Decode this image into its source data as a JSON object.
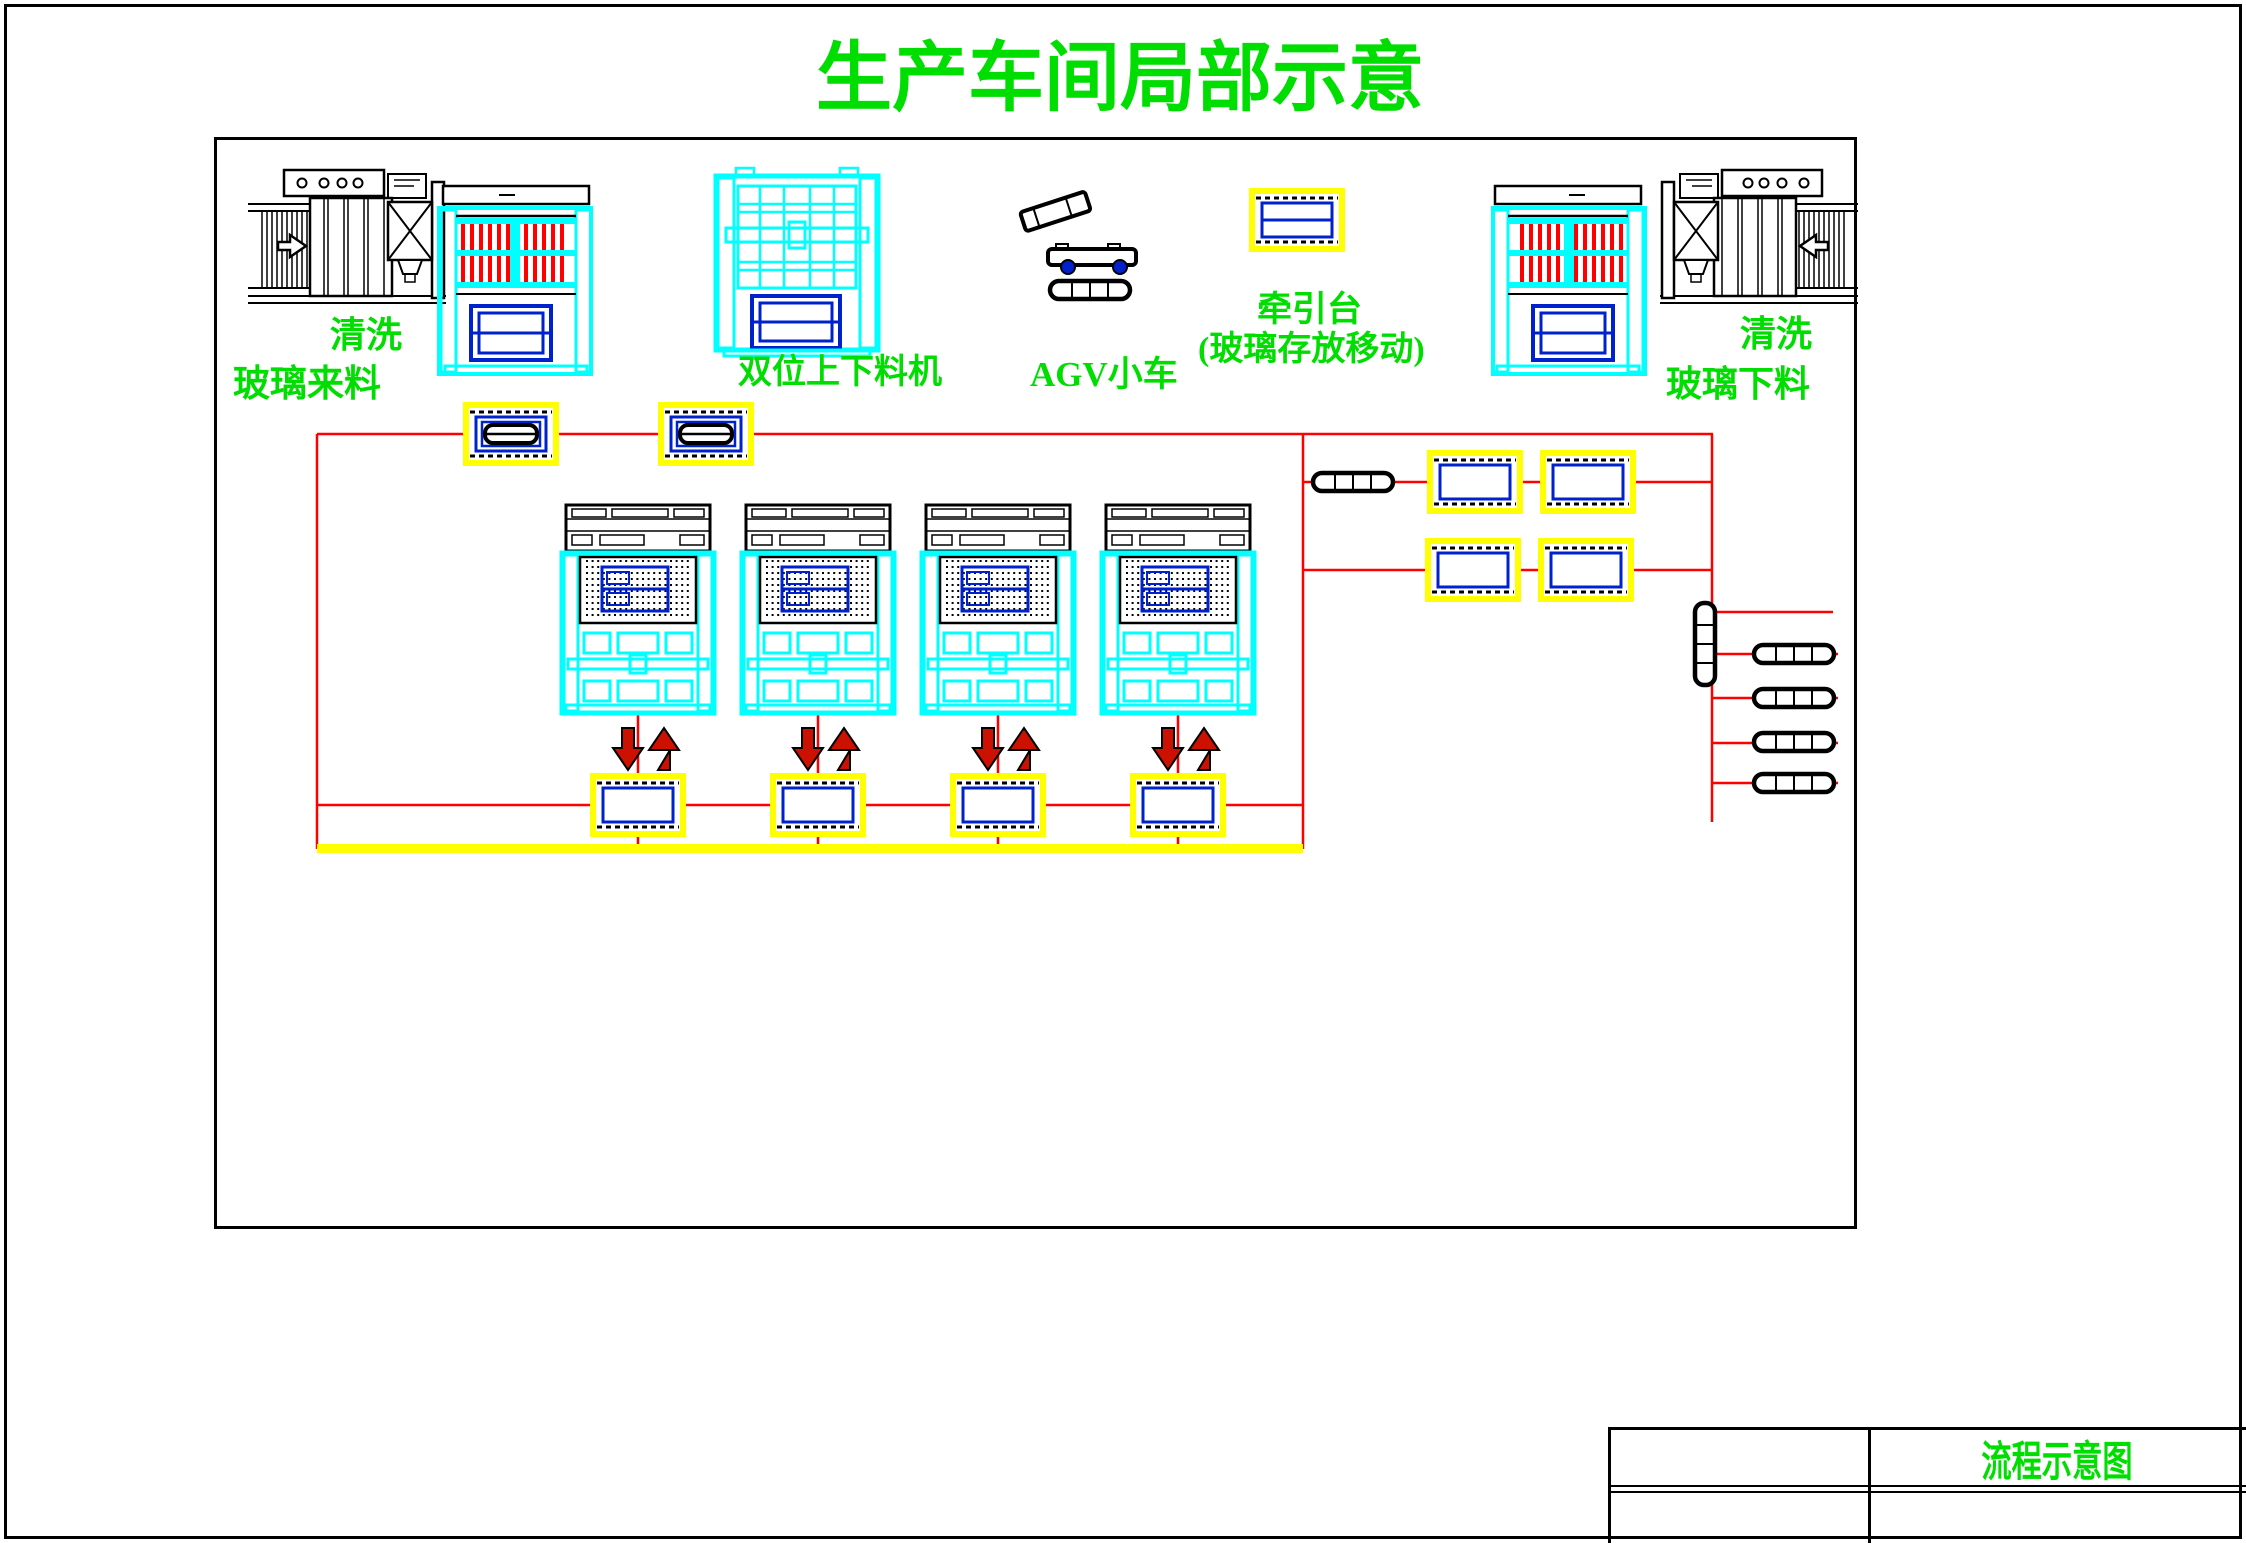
{
  "title": "生产车间局部示意",
  "labels": {
    "wash_left": "清洗",
    "glass_incoming": "玻璃来料",
    "dual_loader": "双位上下料机",
    "agv_cart": "AGV小车",
    "traction_line1": "牵引台",
    "traction_line2": "(玻璃存放移动)",
    "wash_right": "清洗",
    "glass_unloading": "玻璃下料"
  },
  "title_block": {
    "drawing_title": "流程示意图"
  },
  "colors": {
    "label_green": "#00dd00",
    "machine_cyan": "#00ffff",
    "glass_blue": "#0022cc",
    "flow_red": "#ff0000",
    "pallet_yellow": "#ffff00",
    "arrow_red": "#cc1100",
    "line_black": "#000000"
  }
}
